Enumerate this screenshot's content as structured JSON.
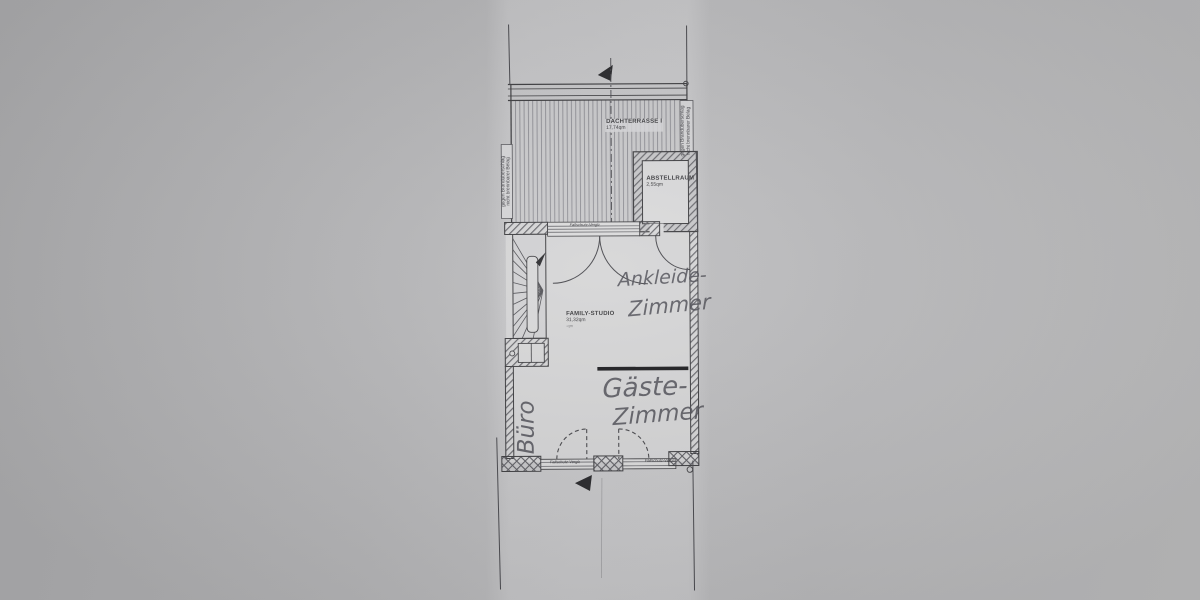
{
  "plan": {
    "rooms": {
      "terrace": {
        "name": "DACHTERRASSE I",
        "area": "17,74qm"
      },
      "storage": {
        "name": "ABSTELLRAUM",
        "area": "2,55qm"
      },
      "family_studio": {
        "name": "FAMILY-STUDIO",
        "area": "31,32qm",
        "note": "-qm"
      }
    },
    "handwritten": {
      "ankleide": {
        "line1": "Ankleide-",
        "line2": "Zimmer"
      },
      "gaeste": {
        "line1": "Gäste-",
        "line2": "Zimmer"
      },
      "buero": "Büro"
    },
    "annotations": {
      "fire_note_line1": "gegen Brandüberschlag",
      "fire_note_line2": "nicht brennbarer Belag",
      "glazing_label": "Fallschutz-Verglasung"
    },
    "colors": {
      "background": "#b8b8ba",
      "paper": "#d6d6d7",
      "ink": "#3f3f42",
      "handwriting": "#54545b"
    }
  }
}
